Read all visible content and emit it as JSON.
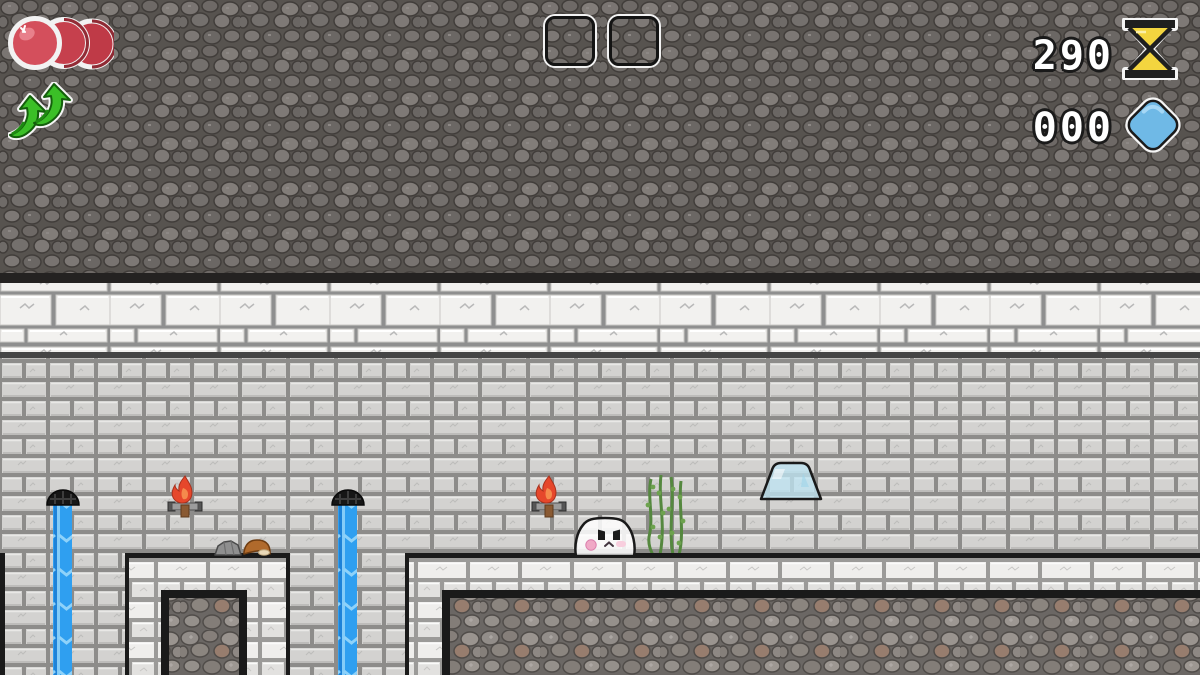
{
  "meta": {
    "app": "pixel-platformer-game",
    "scene": "stone-dungeon-level"
  },
  "hud": {
    "health": {
      "icon": "health-orbs-icon",
      "orb_count": 3,
      "orb_color": "#c84050"
    },
    "double_jump": {
      "icon": "double-jump-arrows-icon",
      "arrow_count": 2,
      "arrow_color": "#3bbf27"
    },
    "item_slots": {
      "count": 2,
      "slot1_content": "",
      "slot2_content": ""
    },
    "timer": {
      "value": "290",
      "icon": "hourglass-icon",
      "sand_color": "#f3d53f"
    },
    "gems": {
      "value": "000",
      "icon": "diamond-icon",
      "gem_color": "#6fb9e6"
    }
  },
  "world": {
    "background_top": "dark-cobblestone",
    "wall": "light-grey-brick-wall",
    "platform_fill": "cobblestone",
    "entities": [
      "waterfall-left",
      "waterfall-middle",
      "torch-left",
      "torch-right",
      "drain-spout-left",
      "drain-spout-middle",
      "ghost-character",
      "vine-plant",
      "glass-dome",
      "rock-prop",
      "mushroom-prop"
    ],
    "water_color": "#2f9ff0"
  }
}
